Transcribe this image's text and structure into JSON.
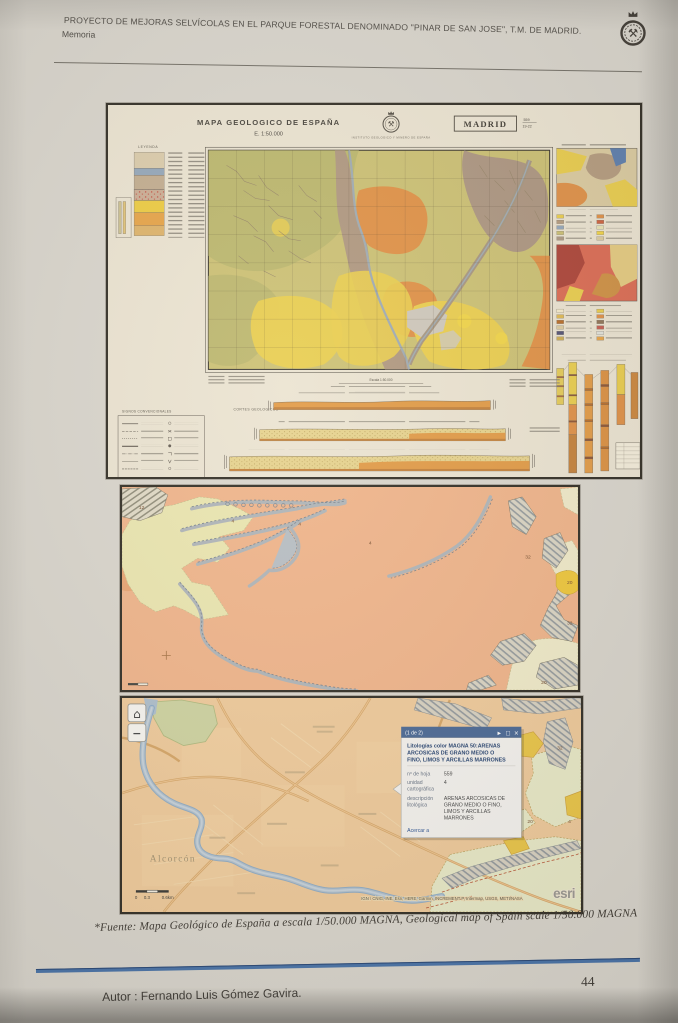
{
  "page": {
    "header_title": "PROYECTO DE MEJORAS SELVÍCOLAS EN EL PARQUE FORESTAL DENOMINADO \"PINAR DE SAN JOSE\", T.M. DE MADRID.",
    "header_subtitle": "Memoria",
    "caption": "*Fuente: Mapa Geológico de España a escala 1/50.000 MAGNA, Geological map of Spain scale 1/50.000 MAGNA",
    "author": "Autor : Fernando Luis Gómez Gavira.",
    "page_number": "44"
  },
  "colors": {
    "popup_header_blue": "#40608f",
    "salmon_unit": "#efb084",
    "yellow_unit": "#e8c23e",
    "footer_line_blue": "#3f6ba3"
  },
  "sheet": {
    "title": "MAPA GEOLOGICO DE ESPAÑA",
    "scale": "E. 1:50.000",
    "institute": "INSTITUTO GEOLOGICO Y MINERO DE ESPAÑA",
    "sheet_name": "MADRID",
    "sheet_number": "559",
    "sheet_grid": "19-22",
    "leyenda_label": "LEYENDA",
    "escala_label": "Escala 1:50.000",
    "cortes_label": "CORTES GEOLOGICOS",
    "signos_label": "SIGNOS CONVENCIONALES"
  },
  "detail_map": {
    "unit_labels": [
      "12",
      "4",
      "4",
      "4",
      "32",
      "20",
      "32",
      "20"
    ]
  },
  "web_map": {
    "controls": {
      "home_icon": "⌂",
      "zoom_out_icon": "−"
    },
    "popup": {
      "pager": "(1 de 2)",
      "expand_icon": "▶",
      "window_icon": "□",
      "close_icon": "×",
      "title_lines": [
        "Litologías color MAGNA 50:ARENAS",
        "ARCOSICAS DE GRANO MEDIO O",
        "FINO, LIMOS Y ARCILLAS MARRONES"
      ],
      "fields": [
        {
          "label": "nº de hoja",
          "value": "559"
        },
        {
          "label_lines": [
            "unidad",
            "cartográfica"
          ],
          "value": "4"
        },
        {
          "label_lines": [
            "descripción",
            "litológica"
          ],
          "value_lines": [
            "ARENAS ARCOSICAS DE",
            "GRANO MEDIO O FINO,",
            "LIMOS Y ARCILLAS",
            "MARRONES"
          ]
        }
      ],
      "link": "Acercar a"
    },
    "place_label": "Alcorcón",
    "unit_labels": [
      "32",
      "20",
      "4"
    ],
    "scale_bar": [
      "0",
      "0.3",
      "0.6km"
    ],
    "attribution": "IGN / CNIG, INE, Esri, HERE, Garmin, INCREMENT P, Intermap, USGS, METI/NASA",
    "logo": "esri"
  }
}
